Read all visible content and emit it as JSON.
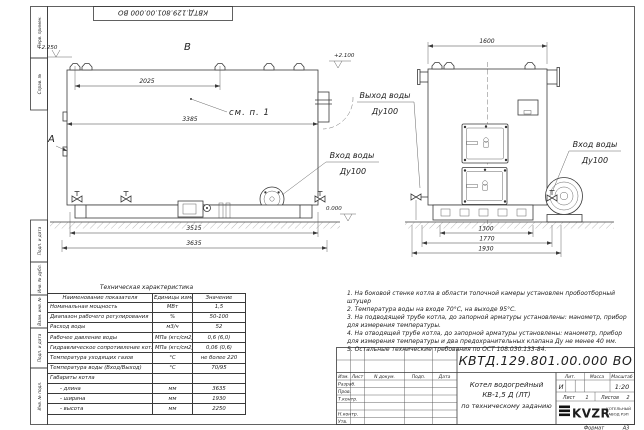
{
  "sheet": {
    "top_stamp": "КВТД.129.801.00.000 ВО",
    "format_label": "Формат",
    "format_value": "А3",
    "margin_labels": [
      "Перв. примен.",
      "Справ. №",
      "Подп. и дата",
      "Инв. № дубл.",
      "Взам. инв. №",
      "Подп. и дата",
      "Инв. № подл."
    ]
  },
  "side_view": {
    "view_label_b": "В",
    "view_label_a": "А",
    "level_top": "+2.250",
    "level_front": "+2.100",
    "level_zero": "0.000",
    "note_ref": "см. п. 1",
    "dim_lugs": "2025",
    "dim_block": "3385",
    "dim_base": "3515",
    "dim_overall": "3635",
    "inlet_label": "Вход воды",
    "inlet_size": "Ду100"
  },
  "front_view": {
    "dim_width": "1600",
    "dim_base": "1300",
    "dim_mid": "1770",
    "dim_overall": "1930",
    "outlet_label": "Выход воды",
    "outlet_size": "Ду100",
    "inlet_label": "Вход воды",
    "inlet_size": "Ду100"
  },
  "notes": [
    "1.  На боковой стенке котла в области топочной камеры установлен пробоотборный штуцер",
    "2.  Температура воды на входе 70°С, на выходе 95°С.",
    "3.  На подводящей трубе котла, до запорной арматуры установлены: манометр, прибор для измерения температуры.",
    "4.  На отводящей трубе котла, до запорной арматуры установлены: манометр, прибор для измерения температуры и два предохранительных клапана Ду не менее 40 мм.",
    "5.  Остальные технические требования по ОСТ 108.030.133-84."
  ],
  "spec_table": {
    "title": "Техническая характеристика",
    "headers": [
      "Наименование показателя",
      "Единицы измерения",
      "Значение"
    ],
    "rows": [
      [
        "Номинальная мощность",
        "МВт",
        "1,5"
      ],
      [
        "Диапазон рабочего регулирования",
        "%",
        "50-100"
      ],
      [
        "Расход воды",
        "м3/ч",
        "52"
      ],
      [
        "Рабочее давление воды",
        "МПа (кгс/см2)",
        "0,6 (6,0)"
      ],
      [
        "Гидравлическое сопротивление котла",
        "МПа (кгс/см2)",
        "0,06 (0,6)"
      ],
      [
        "Температура уходящих газов",
        "°С",
        "не более 220"
      ],
      [
        "Температура воды (Вход/Выход)",
        "°С",
        "70/95"
      ],
      [
        "Габариты котла",
        "",
        ""
      ],
      [
        "- длина",
        "мм",
        "3635"
      ],
      [
        "- ширина",
        "мм",
        "1930"
      ],
      [
        "- высота",
        "мм",
        "2250"
      ]
    ]
  },
  "title_block": {
    "doc_number": "КВТД.129.801.00.000  ВО",
    "product_line1": "Котел водогрейный",
    "product_line2": "КВ-1,5 Д (ЛТ)",
    "product_line3": "по техническому заданию",
    "lit_header": "Лит.",
    "lit_value": "И",
    "mass_header": "Масса",
    "scale_header": "Масштаб",
    "scale_value": "1:20",
    "sheet_label": "Лист",
    "sheet_number": "1",
    "sheets_label": "Листов",
    "sheets_total": "2",
    "logo_text": "KVZR",
    "company_line1": "КОТЕЛЬНЫЙ",
    "company_line2": "ЗАВОД РЭП",
    "rev_headers": [
      "Изм.",
      "Лист",
      "N докум.",
      "Подп.",
      "Дата"
    ],
    "roles": [
      "Разраб.",
      "Пров.",
      "Т.контр.",
      "Н.контр.",
      "Утв."
    ]
  }
}
